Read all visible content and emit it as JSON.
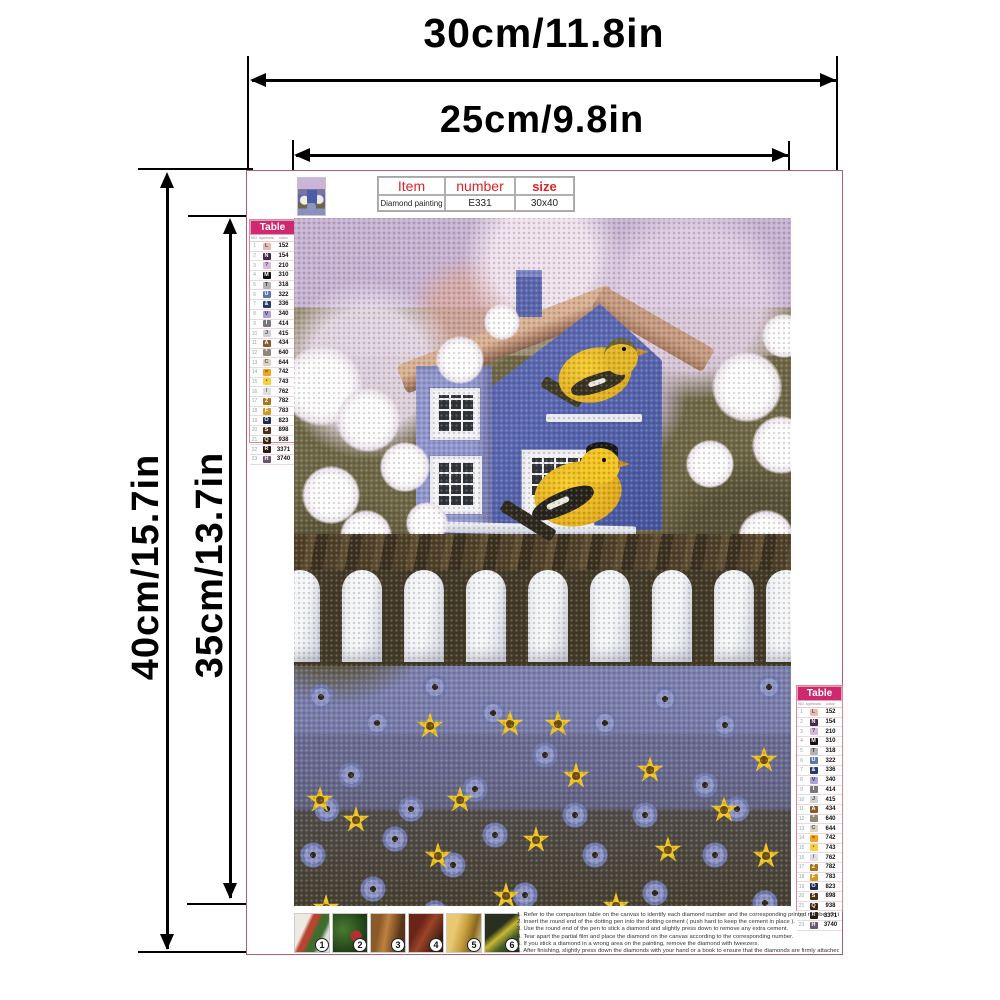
{
  "dimensions": {
    "total_width": "30cm/11.8in",
    "print_width": "25cm/9.8in",
    "total_height": "40cm/15.7in",
    "print_height": "35cm/13.7in"
  },
  "item_table": {
    "headers": [
      "Item",
      "number",
      "size"
    ],
    "values": [
      "Diamond painting",
      "E331",
      "30x40"
    ],
    "header_color": "#e32222"
  },
  "color_table": {
    "title": "Table",
    "columns": [
      "NO.",
      "symbols",
      "color"
    ],
    "header_bg": "#ce296f",
    "rows": [
      {
        "no": "1",
        "sym": "L",
        "code": "152",
        "bg": "#e8bcb4",
        "fg": "#7a4a4a"
      },
      {
        "no": "2",
        "sym": "N",
        "code": "154",
        "bg": "#43284e",
        "fg": "#ffffff"
      },
      {
        "no": "3",
        "sym": "?",
        "code": "210",
        "bg": "#d5b9de",
        "fg": "#5a3a6a"
      },
      {
        "no": "4",
        "sym": "M",
        "code": "310",
        "bg": "#111111",
        "fg": "#ffffff"
      },
      {
        "no": "5",
        "sym": "T",
        "code": "318",
        "bg": "#b2b2b6",
        "fg": "#3a3a3a"
      },
      {
        "no": "6",
        "sym": "U",
        "code": "322",
        "bg": "#5878aa",
        "fg": "#ffffff"
      },
      {
        "no": "7",
        "sym": "&",
        "code": "336",
        "bg": "#24386a",
        "fg": "#ffffff"
      },
      {
        "no": "8",
        "sym": "V",
        "code": "340",
        "bg": "#aba2d8",
        "fg": "#3a3370"
      },
      {
        "no": "9",
        "sym": "I",
        "code": "414",
        "bg": "#77777c",
        "fg": "#ffffff"
      },
      {
        "no": "10",
        "sym": "J",
        "code": "415",
        "bg": "#cfcfd4",
        "fg": "#4a4a52"
      },
      {
        "no": "11",
        "sym": "A",
        "code": "434",
        "bg": "#8a5a2e",
        "fg": "#ffffff"
      },
      {
        "no": "12",
        "sym": "*",
        "code": "640",
        "bg": "#8d8878",
        "fg": "#ffffff"
      },
      {
        "no": "13",
        "sym": "C",
        "code": "644",
        "bg": "#d9d3bf",
        "fg": "#5a5442"
      },
      {
        "no": "14",
        "sym": "=",
        "code": "742",
        "bg": "#f4a41c",
        "fg": "#7a4a08"
      },
      {
        "no": "15",
        "sym": "•",
        "code": "743",
        "bg": "#f7d03c",
        "fg": "#7a5a10"
      },
      {
        "no": "16",
        "sym": "/",
        "code": "762",
        "bg": "#dddde2",
        "fg": "#55555c"
      },
      {
        "no": "17",
        "sym": "Z",
        "code": "782",
        "bg": "#a8761c",
        "fg": "#ffffff"
      },
      {
        "no": "18",
        "sym": "F",
        "code": "783",
        "bg": "#cd9a24",
        "fg": "#ffffff"
      },
      {
        "no": "19",
        "sym": "O",
        "code": "823",
        "bg": "#1c2c50",
        "fg": "#ffffff"
      },
      {
        "no": "20",
        "sym": "S",
        "code": "898",
        "bg": "#4c3112",
        "fg": "#ffffff"
      },
      {
        "no": "21",
        "sym": "Q",
        "code": "938",
        "bg": "#3b250c",
        "fg": "#ffffff"
      },
      {
        "no": "22",
        "sym": "R",
        "code": "3371",
        "bg": "#281b0d",
        "fg": "#ffffff"
      },
      {
        "no": "23",
        "sym": "H",
        "code": "3740",
        "bg": "#6a5570",
        "fg": "#ffffff"
      }
    ]
  },
  "steps": [
    "1",
    "2",
    "3",
    "4",
    "5",
    "6"
  ],
  "instructions": {
    "lines": [
      "1. Refer to the comparison table on the canvas to identify each diamond number and the corresponding printed number on the canvas.",
      "2. Insert the round end of the dotting pen into the dotting cement ( push hard to keep the cement in place ).",
      "3. Use the round end of the pen to stick a diamond and slightly press down to remove any extra cement.",
      "4. Tear apart the partial film and place the diamond on the canvas according to the corresponding number.",
      "5. If you stick a diamond in a wrong area on the painting, remove the diamond with tweezers.",
      "6. After finishing, slightly press down the diamonds with your hand or a book to ensure that the diamonds are firmly attached."
    ]
  }
}
